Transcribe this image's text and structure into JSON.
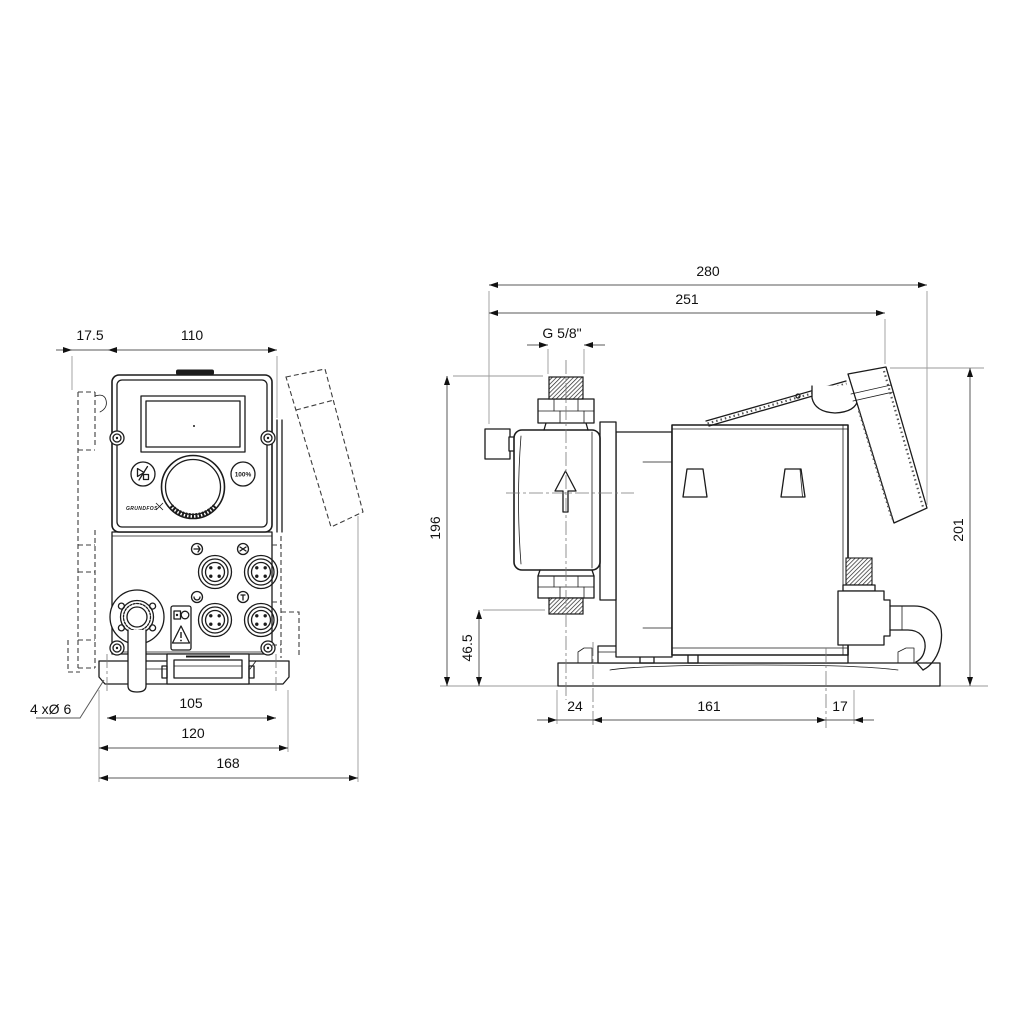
{
  "drawing": {
    "kind": "technical-dimension-drawing",
    "subject": "dosing pump, front and side views",
    "background": "#ffffff",
    "line_color": "#1b1b1b",
    "dim_color": "#5a5a5a"
  },
  "front_view": {
    "dims": {
      "bracket_offset": "17.5",
      "body_width": "110",
      "hole_pitch": "105",
      "plate_width": "120",
      "total_width": "168",
      "holes_note": "4 xØ 6"
    },
    "panel": {
      "percent_button": "100%",
      "logo": "GRUNDFOS"
    }
  },
  "side_view": {
    "dims": {
      "total_depth": "280",
      "depth_to_panel": "251",
      "connection_thread": "G 5/8\"",
      "total_height": "196",
      "valve_height": "46.5",
      "base_front": "24",
      "base_hole_pitch": "161",
      "base_rear": "17",
      "panel_height": "201"
    }
  }
}
